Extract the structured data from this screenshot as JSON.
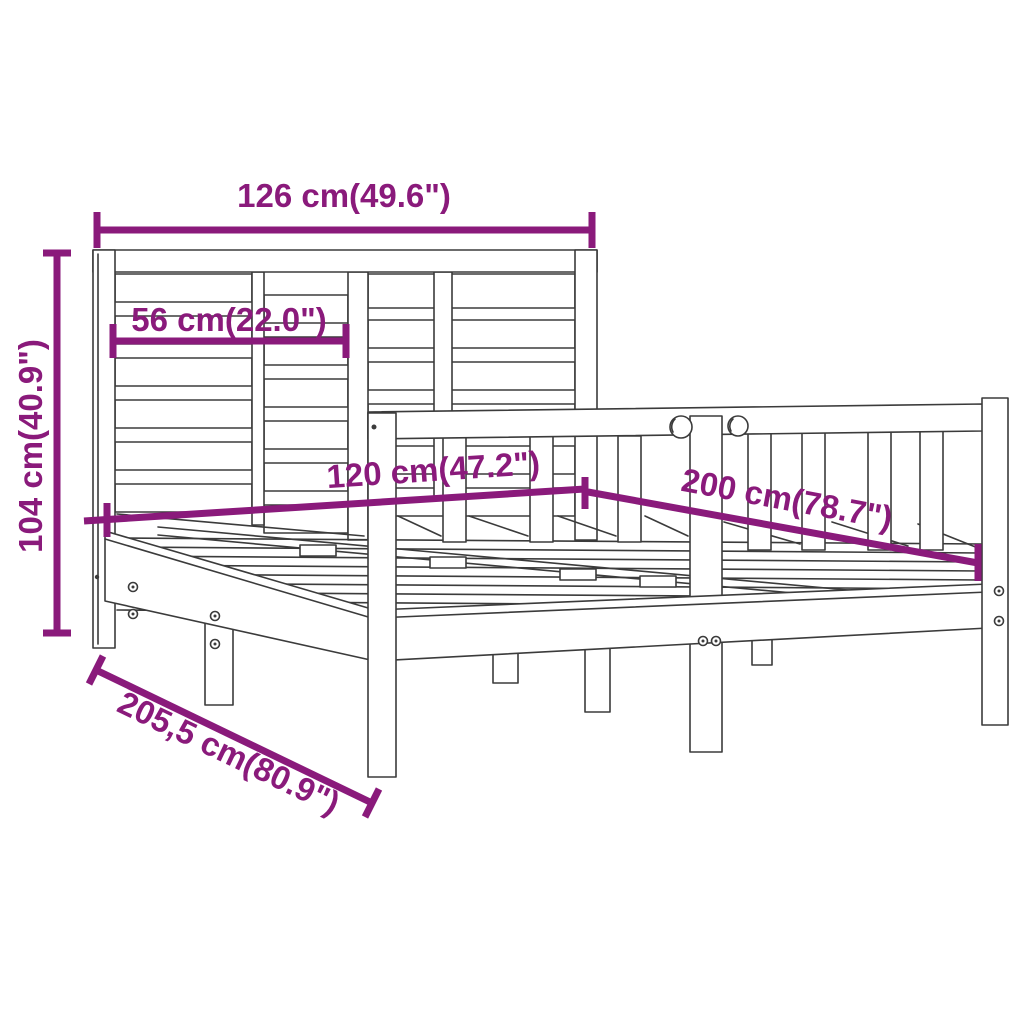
{
  "figure": {
    "type": "product dimension diagram",
    "subject": "wooden bed frame with slatted headboard and slatted base",
    "background_color": "#FFFFFF",
    "drawing_line_color": "#3B3B3B",
    "dimension_color": "#8A1A7B"
  },
  "dimensions": {
    "headboard_width": "126 cm(49.6\")",
    "headboard_slat_width": "56 cm(22.0\")",
    "headboard_height": "104 cm(40.9\")",
    "bed_width": "120 cm(47.2\")",
    "bed_length": "200 cm(78.7\")",
    "frame_total_length": "205,5 cm(80.9\")"
  }
}
